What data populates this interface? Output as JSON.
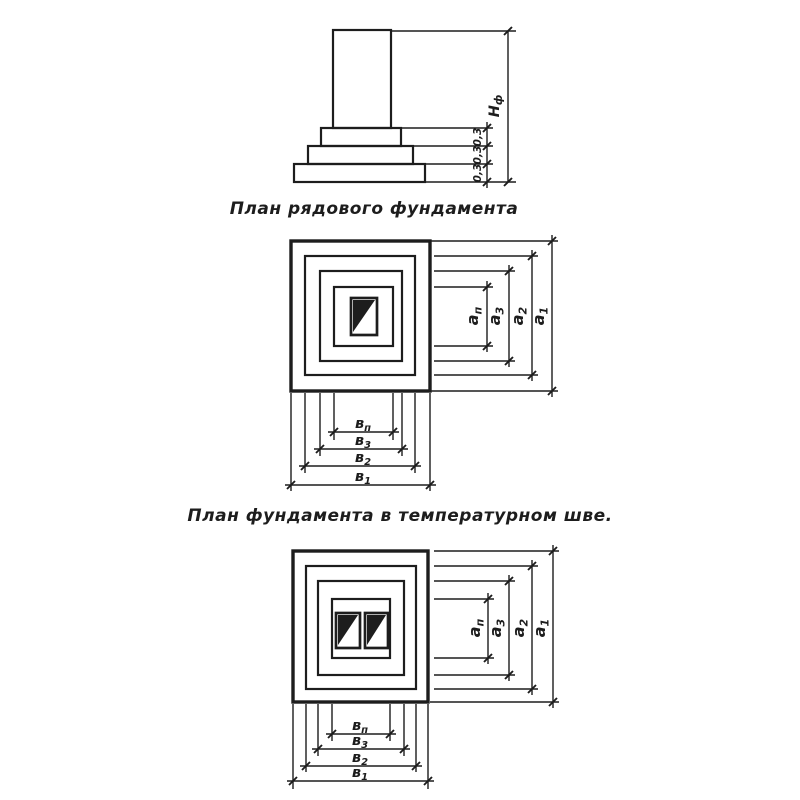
{
  "page": {
    "background": "#ffffff",
    "ink": "#1d1d1d"
  },
  "elevation": {
    "height_label": {
      "base": "Н",
      "sub": "ф"
    },
    "step_heights": [
      "0,3",
      "0,3",
      "0,3"
    ]
  },
  "plan_ordinary": {
    "caption": "План рядового фундамента",
    "length_dims": [
      {
        "base": "а",
        "sub": "п"
      },
      {
        "base": "а",
        "sub": "3"
      },
      {
        "base": "а",
        "sub": "2"
      },
      {
        "base": "а",
        "sub": "1"
      }
    ],
    "width_dims": [
      {
        "base": "в",
        "sub": "п"
      },
      {
        "base": "в",
        "sub": "3"
      },
      {
        "base": "в",
        "sub": "2"
      },
      {
        "base": "в",
        "sub": "1"
      }
    ]
  },
  "plan_expansion_joint": {
    "caption": "План фундамента в температурном шве.",
    "length_dims": [
      {
        "base": "а",
        "sub": "п"
      },
      {
        "base": "а",
        "sub": "3"
      },
      {
        "base": "а",
        "sub": "2"
      },
      {
        "base": "а",
        "sub": "1"
      }
    ],
    "width_dims": [
      {
        "base": "в",
        "sub": "п"
      },
      {
        "base": "в",
        "sub": "3"
      },
      {
        "base": "в",
        "sub": "2"
      },
      {
        "base": "в",
        "sub": "1"
      }
    ]
  }
}
